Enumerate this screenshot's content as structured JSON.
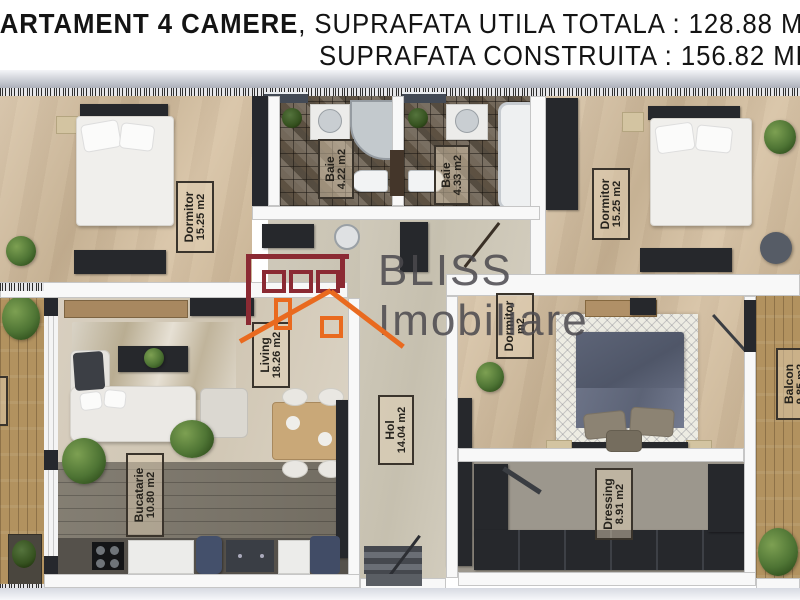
{
  "header": {
    "title_bold": "APARTAMENT 4 CAMERE",
    "title_regular": ", SUPRAFATA UTILA TOTALA : 128.88 MP",
    "subtitle": "SUPRAFATA CONSTRUITA : 156.82 MP"
  },
  "watermark": {
    "line1": "BLISS",
    "line2": "Imobiliare"
  },
  "rooms": {
    "dormitor_left": {
      "name": "Dormitor",
      "area": "15.25 m2"
    },
    "baie_left": {
      "name": "Baie",
      "area": "4.22 m2"
    },
    "baie_right": {
      "name": "Baie",
      "area": "4.33 m2"
    },
    "dormitor_right": {
      "name": "Dormitor",
      "area": "15.25 m2"
    },
    "living": {
      "name": "Living",
      "area": "18.26 m2"
    },
    "hol": {
      "name": "Hol",
      "area": "14.04 m2"
    },
    "bucatarie": {
      "name": "Bucatarie",
      "area": "10.80 m2"
    },
    "dormitor_mid": {
      "name": "Dormitor",
      "area": "m2"
    },
    "dressing": {
      "name": "Dressing",
      "area": "8.91 m2"
    },
    "balcon": {
      "name": "Balcon",
      "area": "9.85 m2"
    }
  },
  "colors": {
    "logo_maroon": "#8B2A33",
    "logo_orange": "#E96A1F",
    "watermark_gray": "#4B494E",
    "wall_dark": "#26282D",
    "floor_beige": "#D5BF9F"
  }
}
